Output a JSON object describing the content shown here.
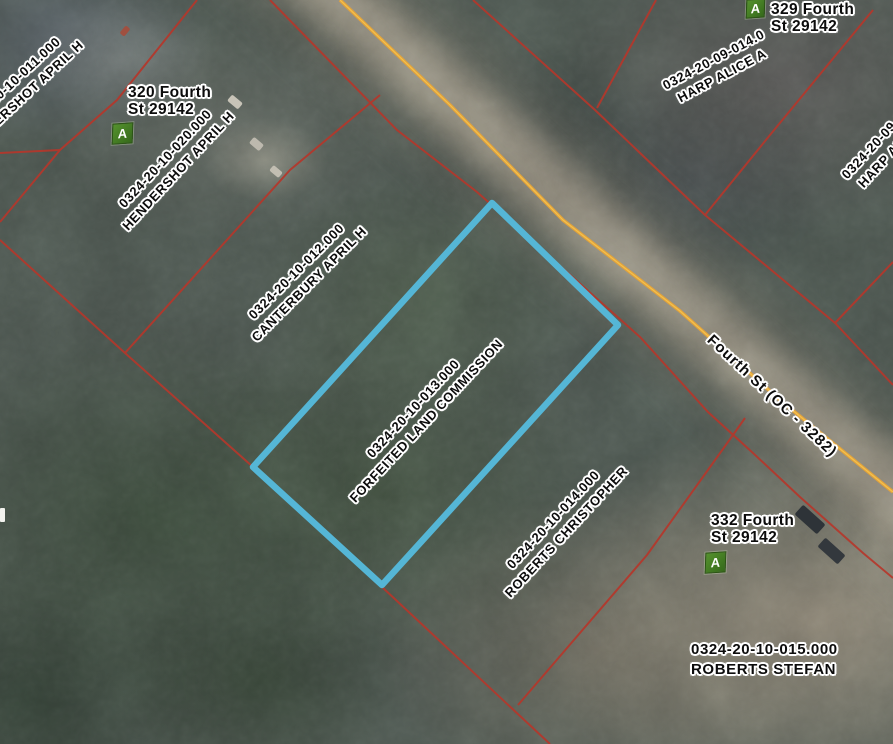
{
  "map": {
    "road": {
      "label": "Fourth St (OC - 3282)"
    },
    "colors": {
      "parcel_line": "#b5372b",
      "road_centerline": "#e2a23b",
      "selected_parcel": "#55b6d6",
      "address_marker_green": "#3e7a20"
    },
    "selected_parcel": {
      "number": "0324-20-10-013.000",
      "owner": "FORFEITED LAND COMMISSION"
    },
    "parcels": {
      "p011": {
        "number": "0324-20-10-011.000",
        "owner": "HENDERSHOT APRIL H"
      },
      "p020": {
        "number": "0324-20-10-020.000",
        "owner": "HENDERSHOT APRIL H"
      },
      "p012": {
        "number": "0324-20-10-012.000",
        "owner": "CANTERBURY APRIL H"
      },
      "p013": {
        "number": "0324-20-10-013.000",
        "owner": "FORFEITED LAND COMMISSION"
      },
      "p014": {
        "number": "0324-20-10-014.000",
        "owner": "ROBERTS CHRISTOPHER"
      },
      "p015": {
        "number": "0324-20-10-015.000",
        "owner": "ROBERTS STEFAN"
      },
      "p09_014": {
        "number": "0324-20-09-014.0",
        "owner": "HARP ALICE A"
      },
      "p09_edge": {
        "number": "0324-20-09-0",
        "owner": "HARP ALIC"
      }
    },
    "addresses": {
      "a320": {
        "line1": "320 Fourth",
        "line2": "St 29142",
        "marker": "A"
      },
      "a329": {
        "line1": "329 Fourth",
        "line2": "St 29142",
        "marker": "A"
      },
      "a332": {
        "line1": "332 Fourth",
        "line2": "St 29142",
        "marker": "A"
      }
    }
  }
}
